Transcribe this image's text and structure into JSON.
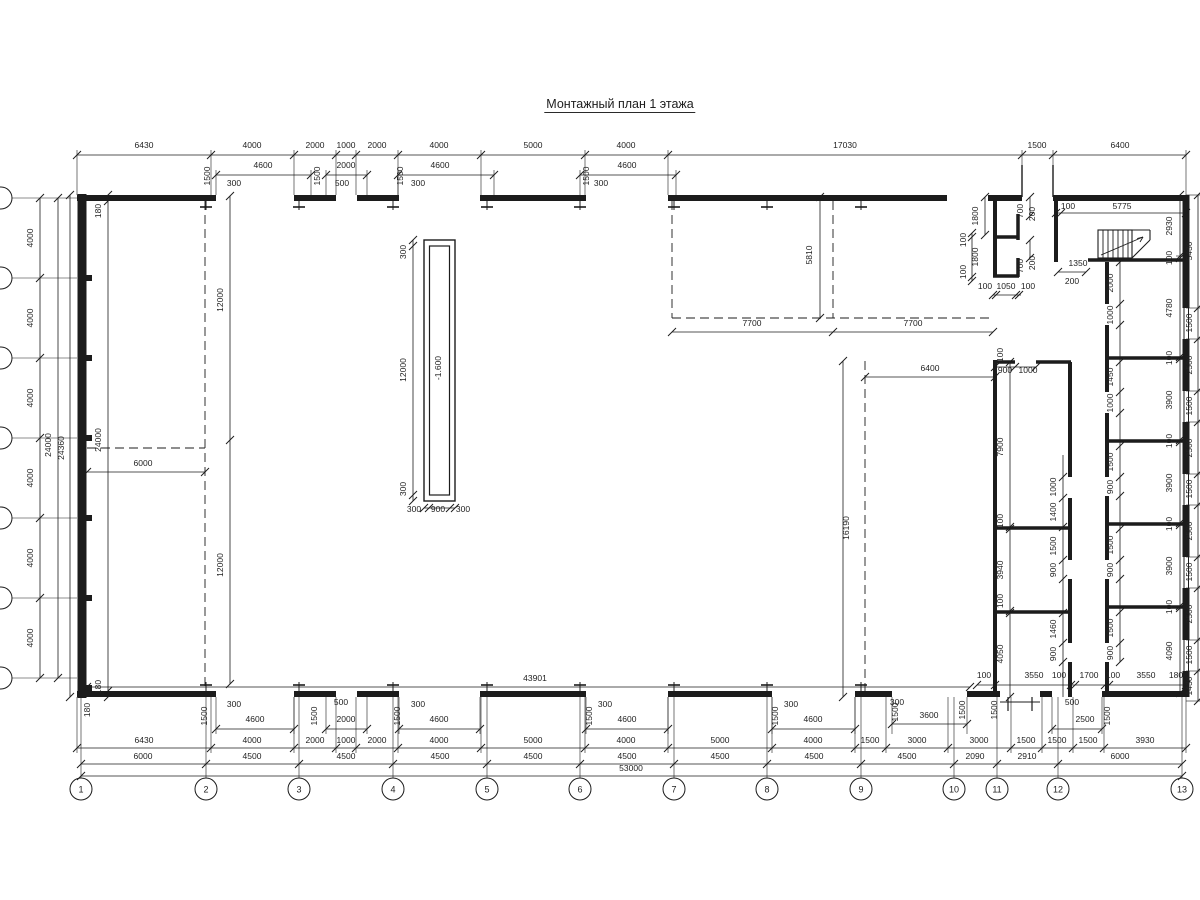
{
  "title": {
    "text": "Монтажный план 1 этажа"
  },
  "pit": {
    "level": "-1.600"
  },
  "axes_bottom": [
    {
      "label": "1",
      "x": 81
    },
    {
      "label": "2",
      "x": 206
    },
    {
      "label": "3",
      "x": 299
    },
    {
      "label": "4",
      "x": 393
    },
    {
      "label": "5",
      "x": 487
    },
    {
      "label": "6",
      "x": 580
    },
    {
      "label": "7",
      "x": 674
    },
    {
      "label": "8",
      "x": 767
    },
    {
      "label": "9",
      "x": 861
    },
    {
      "label": "10",
      "x": 954
    },
    {
      "label": "11",
      "x": 997
    },
    {
      "label": "12",
      "x": 1058
    },
    {
      "label": "13",
      "x": 1182
    }
  ],
  "axes_left_ys": [
    198,
    278,
    358,
    438,
    518,
    598,
    678
  ],
  "labels_h": [
    [
      144,
      148,
      "6430"
    ],
    [
      252,
      148,
      "4000"
    ],
    [
      315,
      148,
      "2000"
    ],
    [
      346,
      148,
      "1000"
    ],
    [
      377,
      148,
      "2000"
    ],
    [
      439,
      148,
      "4000"
    ],
    [
      533,
      148,
      "5000"
    ],
    [
      626,
      148,
      "4000"
    ],
    [
      845,
      148,
      "17030"
    ],
    [
      1037,
      148,
      "1500"
    ],
    [
      1120,
      148,
      "6400"
    ],
    [
      263,
      168,
      "4600"
    ],
    [
      346,
      168,
      "2000"
    ],
    [
      440,
      168,
      "4600"
    ],
    [
      627,
      168,
      "4600"
    ],
    [
      234,
      186,
      "300"
    ],
    [
      342,
      186,
      "500"
    ],
    [
      418,
      186,
      "300"
    ],
    [
      601,
      186,
      "300"
    ],
    [
      1068,
      209,
      "100"
    ],
    [
      1122,
      209,
      "5775"
    ],
    [
      1078,
      266,
      "1350"
    ],
    [
      1072,
      284,
      "200"
    ],
    [
      1005,
      373,
      "900"
    ],
    [
      1028,
      373,
      "1000"
    ],
    [
      930,
      371,
      "6400"
    ],
    [
      752,
      326,
      "7700"
    ],
    [
      913,
      326,
      "7700"
    ],
    [
      985,
      289,
      "100"
    ],
    [
      1006,
      289,
      "1050"
    ],
    [
      1028,
      289,
      "100"
    ],
    [
      414,
      512,
      "300"
    ],
    [
      438,
      512,
      "900"
    ],
    [
      463,
      512,
      "300"
    ],
    [
      143,
      466,
      "6000"
    ],
    [
      535,
      681,
      "43901"
    ],
    [
      984,
      678,
      "100"
    ],
    [
      1034,
      678,
      "3550"
    ],
    [
      1059,
      678,
      "100"
    ],
    [
      1089,
      678,
      "1700"
    ],
    [
      1113,
      678,
      "100"
    ],
    [
      1146,
      678,
      "3550"
    ],
    [
      1176,
      678,
      "180"
    ],
    [
      255,
      722,
      "4600"
    ],
    [
      346,
      722,
      "2000"
    ],
    [
      439,
      722,
      "4600"
    ],
    [
      627,
      722,
      "4600"
    ],
    [
      813,
      722,
      "4600"
    ],
    [
      929,
      718,
      "3600"
    ],
    [
      1085,
      722,
      "2500"
    ],
    [
      234,
      707,
      "300"
    ],
    [
      341,
      705,
      "500"
    ],
    [
      418,
      707,
      "300"
    ],
    [
      605,
      707,
      "300"
    ],
    [
      791,
      707,
      "300"
    ],
    [
      897,
      705,
      "300"
    ],
    [
      1072,
      705,
      "500"
    ],
    [
      144,
      743,
      "6430"
    ],
    [
      252,
      743,
      "4000"
    ],
    [
      315,
      743,
      "2000"
    ],
    [
      346,
      743,
      "1000"
    ],
    [
      377,
      743,
      "2000"
    ],
    [
      439,
      743,
      "4000"
    ],
    [
      533,
      743,
      "5000"
    ],
    [
      626,
      743,
      "4000"
    ],
    [
      720,
      743,
      "5000"
    ],
    [
      813,
      743,
      "4000"
    ],
    [
      870,
      743,
      "1500"
    ],
    [
      917,
      743,
      "3000"
    ],
    [
      979,
      743,
      "3000"
    ],
    [
      1026,
      743,
      "1500"
    ],
    [
      1057,
      743,
      "1500"
    ],
    [
      1088,
      743,
      "1500"
    ],
    [
      1145,
      743,
      "3930"
    ],
    [
      143,
      759,
      "6000"
    ],
    [
      252,
      759,
      "4500"
    ],
    [
      346,
      759,
      "4500"
    ],
    [
      440,
      759,
      "4500"
    ],
    [
      533,
      759,
      "4500"
    ],
    [
      627,
      759,
      "4500"
    ],
    [
      720,
      759,
      "4500"
    ],
    [
      814,
      759,
      "4500"
    ],
    [
      907,
      759,
      "4500"
    ],
    [
      975,
      759,
      "2090"
    ],
    [
      1027,
      759,
      "2910"
    ],
    [
      1120,
      759,
      "6000"
    ],
    [
      631,
      771,
      "53000"
    ]
  ],
  "labels_v": [
    [
      33,
      238,
      "4000"
    ],
    [
      33,
      318,
      "4000"
    ],
    [
      33,
      398,
      "4000"
    ],
    [
      33,
      478,
      "4000"
    ],
    [
      33,
      558,
      "4000"
    ],
    [
      33,
      638,
      "4000"
    ],
    [
      51,
      445,
      "24000"
    ],
    [
      64,
      448,
      "24360"
    ],
    [
      101,
      211,
      "180"
    ],
    [
      101,
      440,
      "24000"
    ],
    [
      101,
      687,
      "180"
    ],
    [
      90,
      710,
      "180"
    ],
    [
      223,
      300,
      "12000"
    ],
    [
      223,
      565,
      "12000"
    ],
    [
      210,
      176,
      "1500"
    ],
    [
      320,
      176,
      "1500"
    ],
    [
      403,
      176,
      "1500"
    ],
    [
      589,
      176,
      "1500"
    ],
    [
      207,
      716,
      "1500"
    ],
    [
      317,
      716,
      "1500"
    ],
    [
      400,
      716,
      "1500"
    ],
    [
      592,
      716,
      "1500"
    ],
    [
      778,
      716,
      "1500"
    ],
    [
      898,
      712,
      "1500"
    ],
    [
      965,
      710,
      "1500"
    ],
    [
      997,
      710,
      "1500"
    ],
    [
      1110,
      716,
      "1500"
    ],
    [
      406,
      252,
      "300"
    ],
    [
      406,
      370,
      "12000"
    ],
    [
      406,
      489,
      "300"
    ],
    [
      441,
      368,
      "-1.600"
    ],
    [
      812,
      255,
      "5810"
    ],
    [
      849,
      528,
      "16190"
    ],
    [
      978,
      216,
      "1800"
    ],
    [
      966,
      240,
      "100"
    ],
    [
      978,
      257,
      "1800"
    ],
    [
      966,
      272,
      "100"
    ],
    [
      1023,
      211,
      "700"
    ],
    [
      1035,
      214,
      "200"
    ],
    [
      1023,
      266,
      "700"
    ],
    [
      1035,
      263,
      "200"
    ],
    [
      1172,
      226,
      "2930"
    ],
    [
      1172,
      258,
      "100"
    ],
    [
      1172,
      308,
      "4780"
    ],
    [
      1172,
      358,
      "100"
    ],
    [
      1172,
      400,
      "3900"
    ],
    [
      1172,
      441,
      "100"
    ],
    [
      1172,
      483,
      "3900"
    ],
    [
      1172,
      524,
      "100"
    ],
    [
      1172,
      566,
      "3900"
    ],
    [
      1172,
      607,
      "100"
    ],
    [
      1172,
      651,
      "4090"
    ],
    [
      1192,
      251,
      "5430"
    ],
    [
      1192,
      323,
      "1500"
    ],
    [
      1192,
      365,
      "2500"
    ],
    [
      1192,
      406,
      "1500"
    ],
    [
      1192,
      448,
      "2500"
    ],
    [
      1192,
      489,
      "1500"
    ],
    [
      1192,
      531,
      "2500"
    ],
    [
      1192,
      572,
      "1500"
    ],
    [
      1192,
      614,
      "2500"
    ],
    [
      1192,
      655,
      "1500"
    ],
    [
      1192,
      686,
      "1430"
    ],
    [
      1003,
      355,
      "100"
    ],
    [
      1003,
      447,
      "7900"
    ],
    [
      1003,
      521,
      "100"
    ],
    [
      1003,
      570,
      "3940"
    ],
    [
      1003,
      601,
      "100"
    ],
    [
      1003,
      654,
      "4050"
    ],
    [
      1113,
      283,
      "2000"
    ],
    [
      1113,
      315,
      "1000"
    ],
    [
      1113,
      377,
      "1450"
    ],
    [
      1113,
      403,
      "1000"
    ],
    [
      1113,
      462,
      "1500"
    ],
    [
      1113,
      487,
      "900"
    ],
    [
      1113,
      545,
      "1500"
    ],
    [
      1113,
      570,
      "900"
    ],
    [
      1113,
      628,
      "1500"
    ],
    [
      1113,
      653,
      "900"
    ],
    [
      1056,
      487,
      "1000"
    ],
    [
      1056,
      512,
      "1400"
    ],
    [
      1056,
      546,
      "1500"
    ],
    [
      1056,
      570,
      "900"
    ],
    [
      1056,
      629,
      "1460"
    ],
    [
      1056,
      654,
      "900"
    ]
  ]
}
